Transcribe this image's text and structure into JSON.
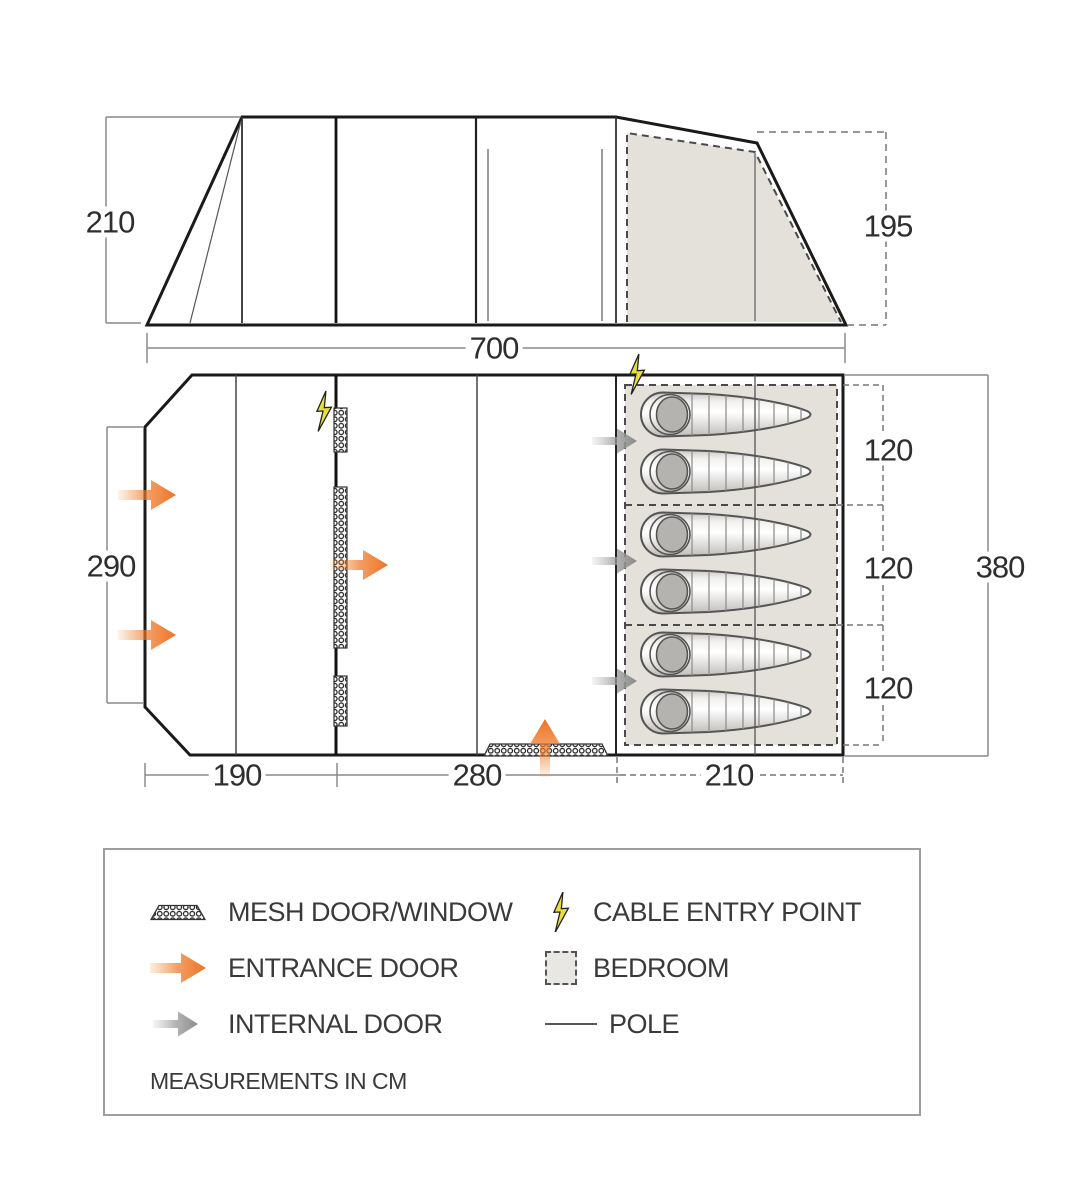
{
  "diagram": {
    "elevation": {
      "height_left": "210",
      "height_right": "195"
    },
    "plan": {
      "width_total": "700",
      "front_depth": "290",
      "side_depth_total": "380",
      "bedroom_sections": [
        "120",
        "120",
        "120"
      ],
      "bottom_widths": [
        "190",
        "280",
        "210"
      ]
    }
  },
  "legend": {
    "items": [
      {
        "icon": "mesh-swatch-icon",
        "label": "MESH DOOR/WINDOW"
      },
      {
        "icon": "lightning-icon",
        "label": "CABLE ENTRY POINT"
      },
      {
        "icon": "entrance-arrow-icon",
        "label": "ENTRANCE DOOR"
      },
      {
        "icon": "bedroom-swatch-icon",
        "label": "BEDROOM"
      },
      {
        "icon": "internal-arrow-icon",
        "label": "INTERNAL DOOR"
      },
      {
        "icon": "pole-line-icon",
        "label": "POLE"
      }
    ],
    "note": "MEASUREMENTS IN CM"
  },
  "colors": {
    "entrance_arrow": "#ec7424",
    "internal_arrow": "#8f8f8f",
    "cable_bolt": "#e9df39",
    "bedroom_fill": "#e4e0da",
    "outline": "#1a1a1a"
  }
}
